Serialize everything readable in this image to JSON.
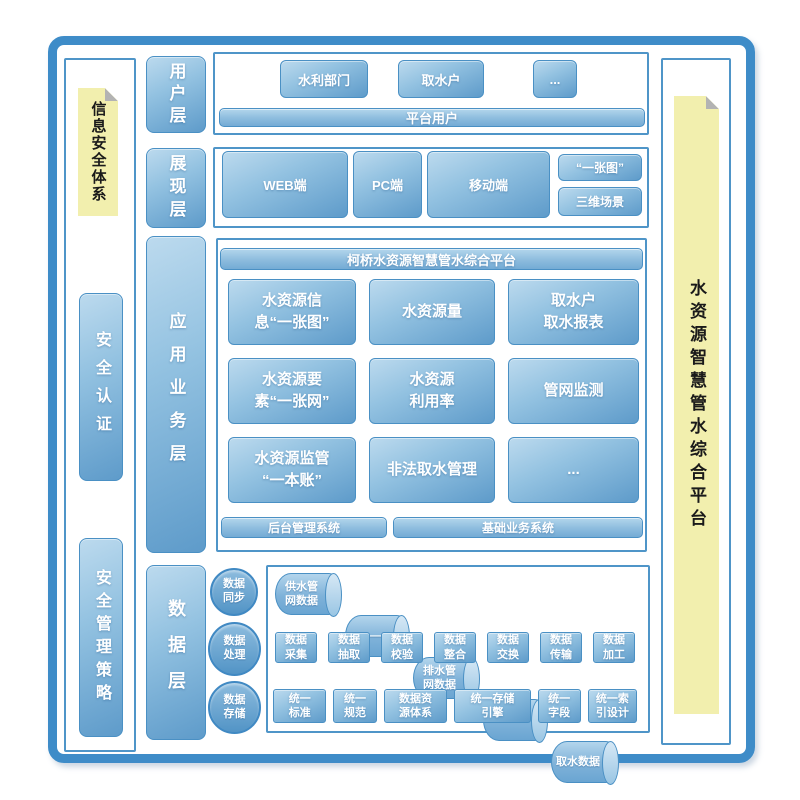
{
  "colors": {
    "accent_blue": "#3e8cc8",
    "box_border": "#4a90c4",
    "note_yellow": "#f2efae"
  },
  "left_sidebar": {
    "note_label": "信息安全体系",
    "items": [
      {
        "label": "安全认证"
      },
      {
        "label": "安全管理策略"
      }
    ]
  },
  "right_sidebar": {
    "note_label": "水资源智慧管水综合平台"
  },
  "layers": {
    "user": {
      "label": "用户层"
    },
    "presentation": {
      "label": "展现层"
    },
    "application": {
      "label": "应用业务层"
    },
    "data": {
      "label": "数据层"
    }
  },
  "user_layer": {
    "boxes": [
      {
        "label": "水利部门"
      },
      {
        "label": "取水户"
      },
      {
        "label": "..."
      }
    ],
    "bar_label": "平台用户"
  },
  "presentation_layer": {
    "boxes": [
      {
        "label": "WEB端"
      },
      {
        "label": "PC端"
      },
      {
        "label": "移动端"
      }
    ],
    "side_boxes": [
      {
        "label": "“一张图”"
      },
      {
        "label": "三维场景"
      }
    ]
  },
  "application_layer": {
    "header_label": "柯桥水资源智慧管水综合平台",
    "grid": [
      {
        "label": "水资源信\n息“一张图”"
      },
      {
        "label": "水资源量"
      },
      {
        "label": "取水户\n取水报表"
      },
      {
        "label": "水资源要\n素“一张网”"
      },
      {
        "label": "水资源\n利用率"
      },
      {
        "label": "管网监测"
      },
      {
        "label": "水资源监管\n“一本账”"
      },
      {
        "label": "非法取水管理"
      },
      {
        "label": "..."
      }
    ],
    "bottom_bars": [
      {
        "label": "后台管理系统"
      },
      {
        "label": "基础业务系统"
      }
    ]
  },
  "data_layer": {
    "circles": [
      {
        "label": "数据\n同步"
      },
      {
        "label": "数据\n处理"
      },
      {
        "label": "数据\n存储"
      }
    ],
    "cylinders": [
      {
        "label": "供水管\n网数据"
      },
      {
        "label": "——"
      },
      {
        "label": "排水管\n网数据"
      },
      {
        "label": "——"
      },
      {
        "label": "取水数据"
      }
    ],
    "process_boxes": [
      {
        "label": "数据\n采集"
      },
      {
        "label": "数据\n抽取"
      },
      {
        "label": "数据\n校验"
      },
      {
        "label": "数据\n整合"
      },
      {
        "label": "数据\n交换"
      },
      {
        "label": "数据\n传输"
      },
      {
        "label": "数据\n加工"
      }
    ],
    "standard_boxes": [
      {
        "label": "统一\n标准"
      },
      {
        "label": "统一\n规范"
      },
      {
        "label": "数据资\n源体系"
      },
      {
        "label": "统一存储\n引擎"
      },
      {
        "label": "统一\n字段"
      },
      {
        "label": "统一索\n引设计"
      }
    ]
  }
}
